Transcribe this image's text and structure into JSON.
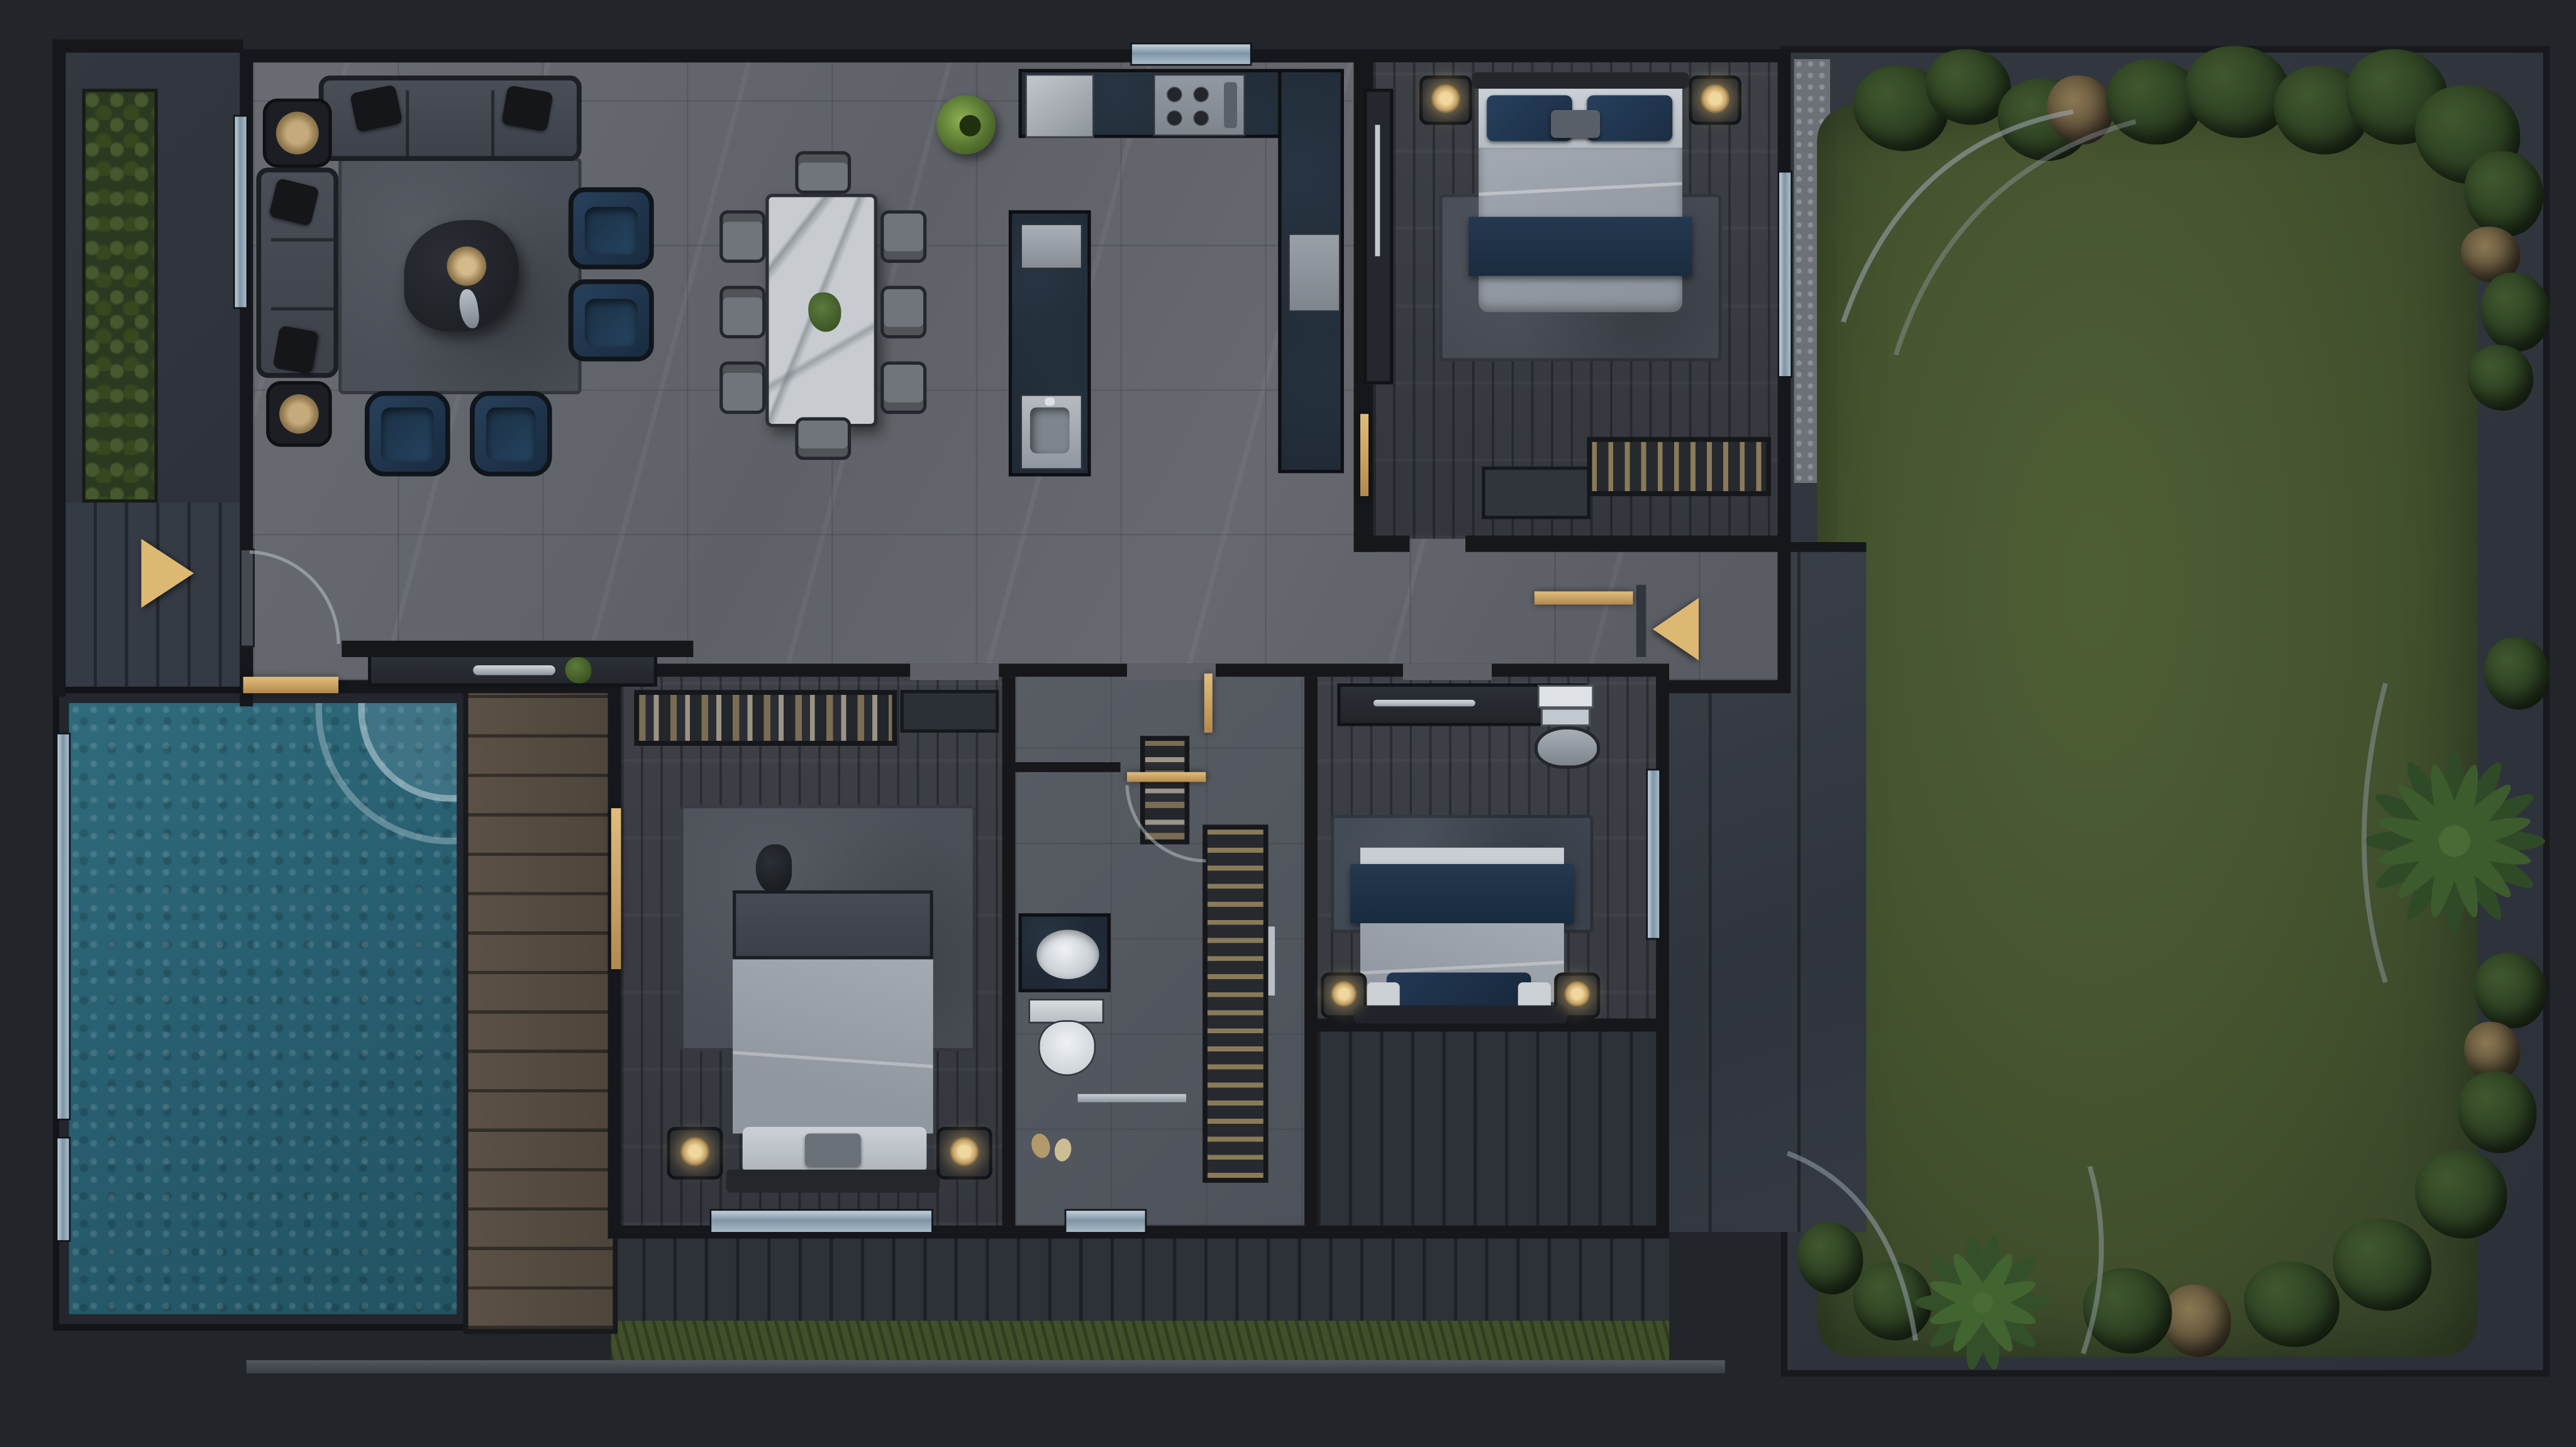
{
  "meta": {
    "title": "Dark modern villa – top-down 3D floor plan render",
    "view": "top-down",
    "visible_text": "none"
  },
  "palette": {
    "background": "#22252a",
    "path": "#31363e",
    "wall": "#15171b",
    "tile_floor": "#63676d",
    "wood_floor": "#3a3e45",
    "counter_navy": "#1f2935",
    "marble": "#c7cbcf",
    "sofa_gray": "#42464e",
    "accent_navy": "#20344a",
    "gold": "#c9a362",
    "window_blue": "#9db3c2",
    "pool_water": "#2a6476",
    "deck_wood": "#564c41",
    "lawn_green": "#46552f",
    "shrub_green": "#2f4526",
    "duvet_gray": "#9ba1aa",
    "rug_gray": "#4b5058",
    "lamp_glow": "#e3c285"
  },
  "rooms": {
    "living": {
      "label": "living room",
      "items": [
        "corner sofa",
        "three-seat sofa",
        "2 navy armchairs",
        "2 navy ottomans",
        "organic coffee table with brass bowl",
        "2 side tables with brass trays",
        "area rug"
      ]
    },
    "dining": {
      "label": "dining area",
      "items": [
        "white marble table",
        "8 gray chairs",
        "green centerpiece",
        "green sculptural bowl"
      ]
    },
    "kitchen": {
      "label": "kitchen",
      "items": [
        "U-shaped navy stone counter",
        "fridge",
        "4-burner cooktop",
        "island with sink",
        "window"
      ]
    },
    "bedroom_top": {
      "label": "bedroom top right",
      "items": [
        "double bed with navy runner",
        "2 nightstands with lit lamps",
        "area rug",
        "slatted bench",
        "dresser",
        "wardrobe panel",
        "window"
      ]
    },
    "bedroom_left": {
      "label": "bedroom bottom left",
      "items": [
        "double bed",
        "2 nightstands with lit lamps",
        "open wardrobe with hanging clothes",
        "area rug",
        "window"
      ]
    },
    "bedroom_right": {
      "label": "bedroom bottom right",
      "items": [
        "double bed with navy band",
        "2 nightstands with lit lamps",
        "desk with papers",
        "desk chair",
        "area rug",
        "window"
      ]
    },
    "bathroom": {
      "label": "bathroom",
      "items": [
        "navy vanity with oval basin",
        "toilet",
        "slatted tall cabinet",
        "hanging-clothes closet",
        "door swing arc",
        "chrome floor strip"
      ]
    },
    "entry": {
      "label": "entry",
      "items": [
        "gold entry arrow",
        "door swing arc",
        "console with plant",
        "gold threshold"
      ]
    },
    "hallway": {
      "label": "hallway",
      "items": [
        "gold side-entry arrow",
        "gold threshold"
      ]
    }
  },
  "outdoor": {
    "pool": {
      "label": "swimming pool",
      "items": [
        "mosaic water",
        "curved corner steps",
        "glazed wall strips"
      ]
    },
    "deck": {
      "label": "timber deck walkway"
    },
    "garden": {
      "label": "lawn garden",
      "items": [
        "rounded lawn",
        "shrub borders",
        "palm rosettes",
        "dry tufts",
        "curved edging"
      ]
    },
    "terrace": {
      "label": "side terrace"
    },
    "hedge": {
      "label": "hedge strip"
    },
    "back_terrace": {
      "label": "rear plank terrace with grass strip"
    }
  },
  "counts": {
    "bedrooms": 3,
    "dining_chairs": 8,
    "armchairs": 2,
    "ottomans": 2,
    "gold_arrows": 2,
    "lit_lamps": 6,
    "windows": 8
  }
}
